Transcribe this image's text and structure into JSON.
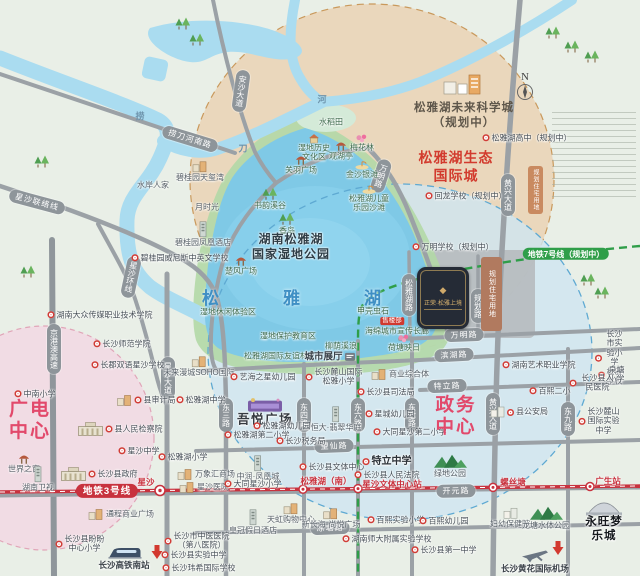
{
  "colors": {
    "line3_red": "#c8323e",
    "line7_green": "#2f9e49",
    "road_grey": "#9ba1a6",
    "lake_blue": "#7fc9e6",
    "tan_zone": "#ead7bc",
    "blue_zone": "#cfe5f0",
    "pink_zone": "#f2dce4",
    "red_title": "#d23b2e",
    "pink_title": "#e2496b",
    "project_dark": "#252b36",
    "project_gold": "#d8b26e"
  },
  "compass": {
    "label": "N"
  },
  "map": {
    "lake_name": "松雅湖"
  },
  "zones": {
    "wetland_park_title": "湖南松雅湖\n国家湿地公园",
    "eco_city_title": "松雅湖生态\n国际城",
    "future_city_title": "松雅湖未来科学城\n（规划中）",
    "broadcast_center_title": "广电\n中心",
    "govt_center_title": "政务\n中心",
    "planned_residential_label": "规划住宅用地"
  },
  "project": {
    "name": "正荣·松雅上境",
    "emblem": "◆"
  },
  "metro": {
    "line3_label": "地铁3号线",
    "line7_label": "地铁7号线（规划中）",
    "stations": [
      {
        "t": "星沙",
        "x": 146,
        "y": 482
      },
      {
        "t": "松雅湖（南）",
        "x": 326,
        "y": 481
      },
      {
        "t": "星沙文体中心站",
        "x": 392,
        "y": 484
      },
      {
        "t": "螺丝塘",
        "x": 513,
        "y": 482
      },
      {
        "t": "广生站",
        "x": 608,
        "y": 481
      }
    ]
  },
  "pills": [
    {
      "t": "捞刀河南路",
      "x": 190,
      "y": 139,
      "r": 17
    },
    {
      "t": "安沙大道",
      "x": 241,
      "y": 91,
      "v": 1,
      "r": 8
    },
    {
      "t": "星沙联络线",
      "x": 37,
      "y": 202,
      "r": 15
    },
    {
      "t": "星沙环线",
      "x": 131,
      "y": 277,
      "v": 1,
      "r": 12
    },
    {
      "t": "京港澳高速",
      "x": 54,
      "y": 349,
      "v": 1
    },
    {
      "t": "星沙大道",
      "x": 168,
      "y": 378,
      "v": 1
    },
    {
      "t": "万明路",
      "x": 381,
      "y": 176,
      "v": 1,
      "r": 18
    },
    {
      "t": "万明路",
      "x": 464,
      "y": 335,
      "r": -2
    },
    {
      "t": "滨湖路",
      "x": 454,
      "y": 355,
      "r": -3
    },
    {
      "t": "特立路",
      "x": 447,
      "y": 386,
      "r": -2
    },
    {
      "t": "望仙路",
      "x": 334,
      "y": 446,
      "r": -2
    },
    {
      "t": "开元路",
      "x": 456,
      "y": 491,
      "r": -1
    },
    {
      "t": "凉塘路",
      "x": 330,
      "y": 528,
      "r": -2
    },
    {
      "t": "东三路",
      "x": 226,
      "y": 415,
      "v": 1
    },
    {
      "t": "东四路",
      "x": 304,
      "y": 415,
      "v": 1
    },
    {
      "t": "东六路",
      "x": 358,
      "y": 415,
      "v": 1
    },
    {
      "t": "东七路",
      "x": 412,
      "y": 415,
      "v": 1
    },
    {
      "t": "东九路",
      "x": 568,
      "y": 419,
      "v": 1
    },
    {
      "t": "黄兴大道",
      "x": 508,
      "y": 195,
      "v": 1
    },
    {
      "t": "黄兴大道",
      "x": 493,
      "y": 414,
      "v": 1
    },
    {
      "t": "松雅湖路",
      "x": 409,
      "y": 295,
      "v": 1
    },
    {
      "t": "规划路",
      "x": 478,
      "y": 306,
      "v": 1
    }
  ],
  "trees": [
    [
      183,
      24
    ],
    [
      197,
      40
    ],
    [
      553,
      33
    ],
    [
      572,
      47
    ],
    [
      592,
      57
    ],
    [
      42,
      162
    ],
    [
      28,
      272
    ],
    [
      588,
      280
    ],
    [
      602,
      293
    ]
  ],
  "pois": [
    {
      "t": "捞",
      "x": 140,
      "y": 117,
      "c": "riv"
    },
    {
      "t": "刀",
      "x": 243,
      "y": 149,
      "c": "riv"
    },
    {
      "t": "河",
      "x": 322,
      "y": 100,
      "c": "riv"
    },
    {
      "t": "水稻田",
      "x": 331,
      "y": 122,
      "c": "p"
    },
    {
      "t": "湿地历史\n文化区",
      "x": 314,
      "y": 148,
      "c": "p",
      "i": "hut"
    },
    {
      "t": "观湖亭",
      "x": 341,
      "y": 151,
      "c": "p",
      "i": "pavilion"
    },
    {
      "t": "梅花林",
      "x": 362,
      "y": 143,
      "c": "p",
      "i": "flower"
    },
    {
      "t": "关羽广场",
      "x": 301,
      "y": 165,
      "c": "p",
      "i": "pavilion"
    },
    {
      "t": "金沙银滩",
      "x": 362,
      "y": 170,
      "c": "p",
      "i": "beach"
    },
    {
      "t": "松雅湖儿童\n乐园沙滩",
      "x": 369,
      "y": 199,
      "c": "p",
      "i": "beach"
    },
    {
      "t": "书韵溪谷",
      "x": 270,
      "y": 199,
      "c": "p",
      "i": "trees"
    },
    {
      "t": "香岛",
      "x": 287,
      "y": 224,
      "c": "p",
      "i": "trees"
    },
    {
      "t": "楚风广场",
      "x": 241,
      "y": 266,
      "c": "p",
      "i": "pavilion"
    },
    {
      "t": "湿地休闲体验区",
      "x": 228,
      "y": 312,
      "c": "p"
    },
    {
      "t": "湿地保护教育区",
      "x": 288,
      "y": 336,
      "c": "p"
    },
    {
      "t": "松雅湖国际友谊林",
      "x": 276,
      "y": 356,
      "c": "p"
    },
    {
      "t": "柳荫溪浪",
      "x": 341,
      "y": 346,
      "c": "p"
    },
    {
      "t": "城市展厅",
      "x": 330,
      "y": 357,
      "c": "ch",
      "i": "sign",
      "ip": "right"
    },
    {
      "t": "甲壳虫石",
      "x": 373,
      "y": 311,
      "c": "p"
    },
    {
      "t": "售楼部",
      "x": 392,
      "y": 321,
      "c": "flag"
    },
    {
      "t": "海绵城市宣传长廊",
      "x": 397,
      "y": 331,
      "c": "p"
    },
    {
      "t": "荷塘映日",
      "x": 404,
      "y": 343,
      "c": "p",
      "i": "flower"
    },
    {
      "t": "水岸人家",
      "x": 153,
      "y": 185,
      "c": "g"
    },
    {
      "t": "碧桂园天玺湾",
      "x": 200,
      "y": 171,
      "c": "g",
      "i": "building"
    },
    {
      "t": "月时光",
      "x": 207,
      "y": 207,
      "c": "g"
    },
    {
      "t": "碧桂园凤凰酒店",
      "x": 203,
      "y": 234,
      "c": "g",
      "i": "building-tall"
    },
    {
      "t": "碧桂园威尼斯中英文学校",
      "x": 180,
      "y": 258,
      "c": "s"
    },
    {
      "t": "",
      "x": 462,
      "y": 85,
      "i": "building-cluster"
    },
    {
      "t": "松雅湖高中（规划中）",
      "x": 527,
      "y": 138,
      "c": "s"
    },
    {
      "t": "回龙学校（规划中）",
      "x": 466,
      "y": 196,
      "c": "s"
    },
    {
      "t": "万明学校（规划中）",
      "x": 453,
      "y": 247,
      "c": "s"
    },
    {
      "t": "湖南大众传媒职业技术学院",
      "x": 100,
      "y": 315,
      "c": "s"
    },
    {
      "t": "长沙师范学院",
      "x": 122,
      "y": 344,
      "c": "s"
    },
    {
      "t": "长郡双语星沙学校",
      "x": 128,
      "y": 365,
      "c": "s"
    },
    {
      "t": "未来漫城SOHO国际",
      "x": 199,
      "y": 366,
      "c": "g",
      "i": "building"
    },
    {
      "t": "松雅湖中学",
      "x": 201,
      "y": 400,
      "c": "s"
    },
    {
      "t": "县审计局",
      "x": 146,
      "y": 400,
      "c": "s",
      "i": "building",
      "ip": "left"
    },
    {
      "t": "县人民检察院",
      "x": 120,
      "y": 429,
      "c": "s",
      "i": "gov"
    },
    {
      "t": "中南小学",
      "x": 35,
      "y": 394,
      "c": "s"
    },
    {
      "t": "世界之窗",
      "x": 24,
      "y": 464,
      "c": "g",
      "i": "pavilion"
    },
    {
      "t": "湖南卫视",
      "x": 38,
      "y": 479,
      "c": "g",
      "i": "building-tall"
    },
    {
      "t": "星沙中学",
      "x": 139,
      "y": 451,
      "c": "s"
    },
    {
      "t": "长沙县政府",
      "x": 99,
      "y": 474,
      "c": "s",
      "i": "gov"
    },
    {
      "t": "通程商业广场",
      "x": 121,
      "y": 514,
      "c": "g",
      "i": "building",
      "ip": "left"
    },
    {
      "t": "长沙县盼盼\n中心小学",
      "x": 80,
      "y": 544,
      "c": "s"
    },
    {
      "t": "长沙高铁南站",
      "x": 124,
      "y": 558,
      "c": "bd9",
      "i": "train"
    },
    {
      "t": "",
      "x": 157,
      "y": 552,
      "i": "red-arrow-down"
    },
    {
      "t": "松雅湖小学",
      "x": 183,
      "y": 457,
      "c": "s"
    },
    {
      "t": "万象汇商场",
      "x": 206,
      "y": 474,
      "c": "g",
      "i": "building",
      "ip": "left"
    },
    {
      "t": "星沙医院",
      "x": 204,
      "y": 487,
      "c": "g",
      "i": "building",
      "ip": "left"
    },
    {
      "t": "长沙市中医医院\n（第八医院）",
      "x": 197,
      "y": 541,
      "c": "s"
    },
    {
      "t": "长沙县实验中学",
      "x": 194,
      "y": 555,
      "c": "s"
    },
    {
      "t": "长沙玮希国际学校",
      "x": 199,
      "y": 568,
      "c": "s"
    },
    {
      "t": "艺海之星幼儿园",
      "x": 263,
      "y": 377,
      "c": "s"
    },
    {
      "t": "长沙麓山国际\n松雅小学",
      "x": 334,
      "y": 377,
      "c": "s"
    },
    {
      "t": "商业综合体",
      "x": 400,
      "y": 374,
      "c": "g",
      "i": "building",
      "ip": "left"
    },
    {
      "t": "长沙县司法局",
      "x": 386,
      "y": 392,
      "c": "s"
    },
    {
      "t": "吾悦广场",
      "x": 265,
      "y": 412,
      "c": "mall",
      "i": "mall"
    },
    {
      "t": "松雅湖幼儿园",
      "x": 282,
      "y": 426,
      "c": "s"
    },
    {
      "t": "松雅湖第二小学",
      "x": 257,
      "y": 435,
      "c": "s"
    },
    {
      "t": "长沙税务局",
      "x": 301,
      "y": 441,
      "c": "s"
    },
    {
      "t": "恒大·翡翠华庭",
      "x": 336,
      "y": 419,
      "c": "g",
      "i": "building-tall"
    },
    {
      "t": "星城幼儿园",
      "x": 390,
      "y": 414,
      "c": "s"
    },
    {
      "t": "大同星沙第二小学",
      "x": 410,
      "y": 432,
      "c": "s"
    },
    {
      "t": "中润·凤凰城",
      "x": 258,
      "y": 468,
      "c": "g",
      "i": "building-tall"
    },
    {
      "t": "大同星沙小学",
      "x": 253,
      "y": 484,
      "c": "s"
    },
    {
      "t": "皇冠假日酒店",
      "x": 253,
      "y": 522,
      "c": "g",
      "i": "building-tall"
    },
    {
      "t": "天虹购物中心",
      "x": 291,
      "y": 513,
      "c": "g",
      "i": "building"
    },
    {
      "t": "新长海·尚悦广场",
      "x": 331,
      "y": 518,
      "c": "g",
      "i": "building"
    },
    {
      "t": "长沙县文体中心",
      "x": 332,
      "y": 467,
      "c": "s"
    },
    {
      "t": "特立中学",
      "x": 387,
      "y": 462,
      "c": "sb"
    },
    {
      "t": "长沙县人民法院",
      "x": 387,
      "y": 475,
      "c": "s"
    },
    {
      "t": "百熙实验小学",
      "x": 396,
      "y": 520,
      "c": "s"
    },
    {
      "t": "湖南师大附属实验学校",
      "x": 387,
      "y": 539,
      "c": "s"
    },
    {
      "t": "湖南艺术职业学院",
      "x": 539,
      "y": 365,
      "c": "s"
    },
    {
      "t": "长沙市实验小学\n松雅学校",
      "x": 610,
      "y": 358,
      "c": "s"
    },
    {
      "t": "泉塘小学",
      "x": 612,
      "y": 375,
      "c": "s"
    },
    {
      "t": "长沙县人民医院",
      "x": 593,
      "y": 383,
      "c": "s"
    },
    {
      "t": "百熙二小",
      "x": 550,
      "y": 391,
      "c": "s"
    },
    {
      "t": "县公安局",
      "x": 519,
      "y": 412,
      "c": "s",
      "i": "building-white"
    },
    {
      "t": "长沙麓山国际实验中学",
      "x": 599,
      "y": 421,
      "c": "s"
    },
    {
      "t": "绿地公园",
      "x": 450,
      "y": 466,
      "c": "g",
      "i": "mountains"
    },
    {
      "t": "百熙幼儿园",
      "x": 444,
      "y": 521,
      "c": "s"
    },
    {
      "t": "妇幼保健院",
      "x": 510,
      "y": 518,
      "c": "g",
      "i": "building-white"
    },
    {
      "t": "龙塘水体公园",
      "x": 546,
      "y": 518,
      "c": "g",
      "i": "mountains"
    },
    {
      "t": "长沙县第一中学",
      "x": 444,
      "y": 550,
      "c": "s"
    },
    {
      "t": "长沙黄花国际机场",
      "x": 535,
      "y": 561,
      "c": "bd9",
      "i": "plane"
    },
    {
      "t": "",
      "x": 558,
      "y": 548,
      "i": "red-arrow-down"
    },
    {
      "t": "永旺梦乐城",
      "x": 604,
      "y": 521,
      "c": "aeon",
      "i": "dome"
    },
    {
      "t": "地铁3号线",
      "x": 107,
      "y": 491,
      "c": "pill3"
    },
    {
      "t": "地铁7号线（规划中）",
      "x": 566,
      "y": 254,
      "c": "pill7"
    }
  ]
}
